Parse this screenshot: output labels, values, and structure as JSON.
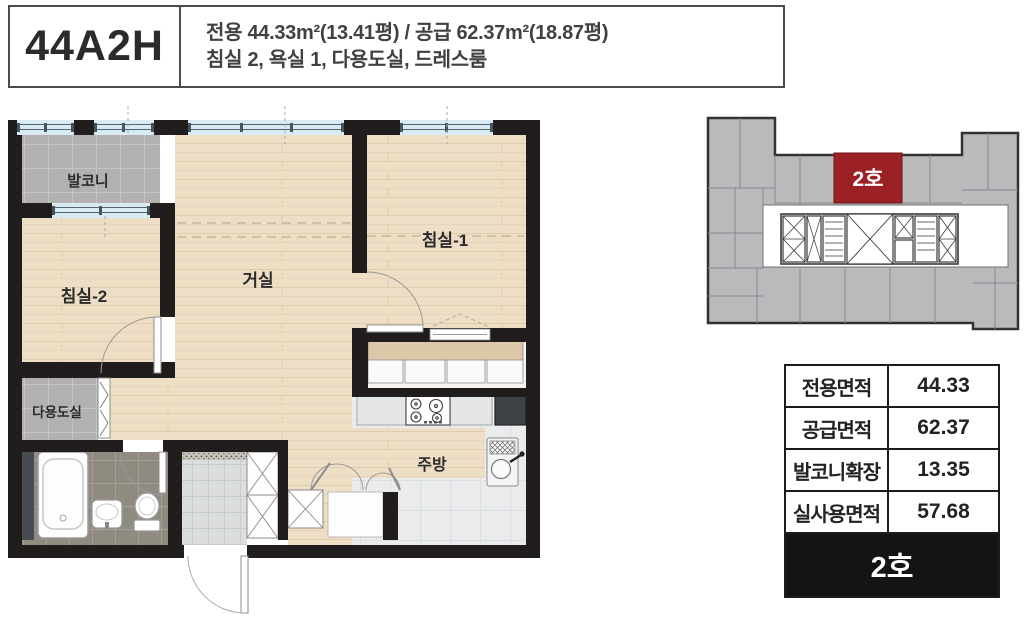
{
  "header": {
    "unit_type": "44A2H",
    "spec_line1": "전용 44.33m²(13.41평) / 공급 62.37m²(18.87평)",
    "spec_line2": "침실 2, 욕실 1, 다용도실, 드레스룸"
  },
  "floorplan": {
    "rooms": [
      {
        "id": "balcony",
        "label": "발코니"
      },
      {
        "id": "bedroom2",
        "label": "침실-2"
      },
      {
        "id": "living",
        "label": "거실"
      },
      {
        "id": "bedroom1",
        "label": "침실-1"
      },
      {
        "id": "utility",
        "label": "다용도실"
      },
      {
        "id": "kitchen",
        "label": "주방"
      }
    ]
  },
  "keyplan": {
    "highlight_label": "2호",
    "highlight_color": "#9c2125"
  },
  "area_table": {
    "rows": [
      {
        "label": "전용면적",
        "value": "44.33"
      },
      {
        "label": "공급면적",
        "value": "62.37"
      },
      {
        "label": "발코니확장",
        "value": "13.35"
      },
      {
        "label": "실사용면적",
        "value": "57.68"
      }
    ],
    "footer_label": "2호"
  },
  "colors": {
    "wall": "#201d1c",
    "wood_floor": "#efdec6",
    "balcony_tile": "#b2b1af",
    "bath_tile": "#8f8b80",
    "entrance_tile": "#dbddde",
    "kitchen_tile": "#e9ebed",
    "window_blue": "#d8ebf5",
    "highlight_red": "#9c2125",
    "keyplan_gray": "#b9babc",
    "table_border": "#1c1c1c"
  }
}
